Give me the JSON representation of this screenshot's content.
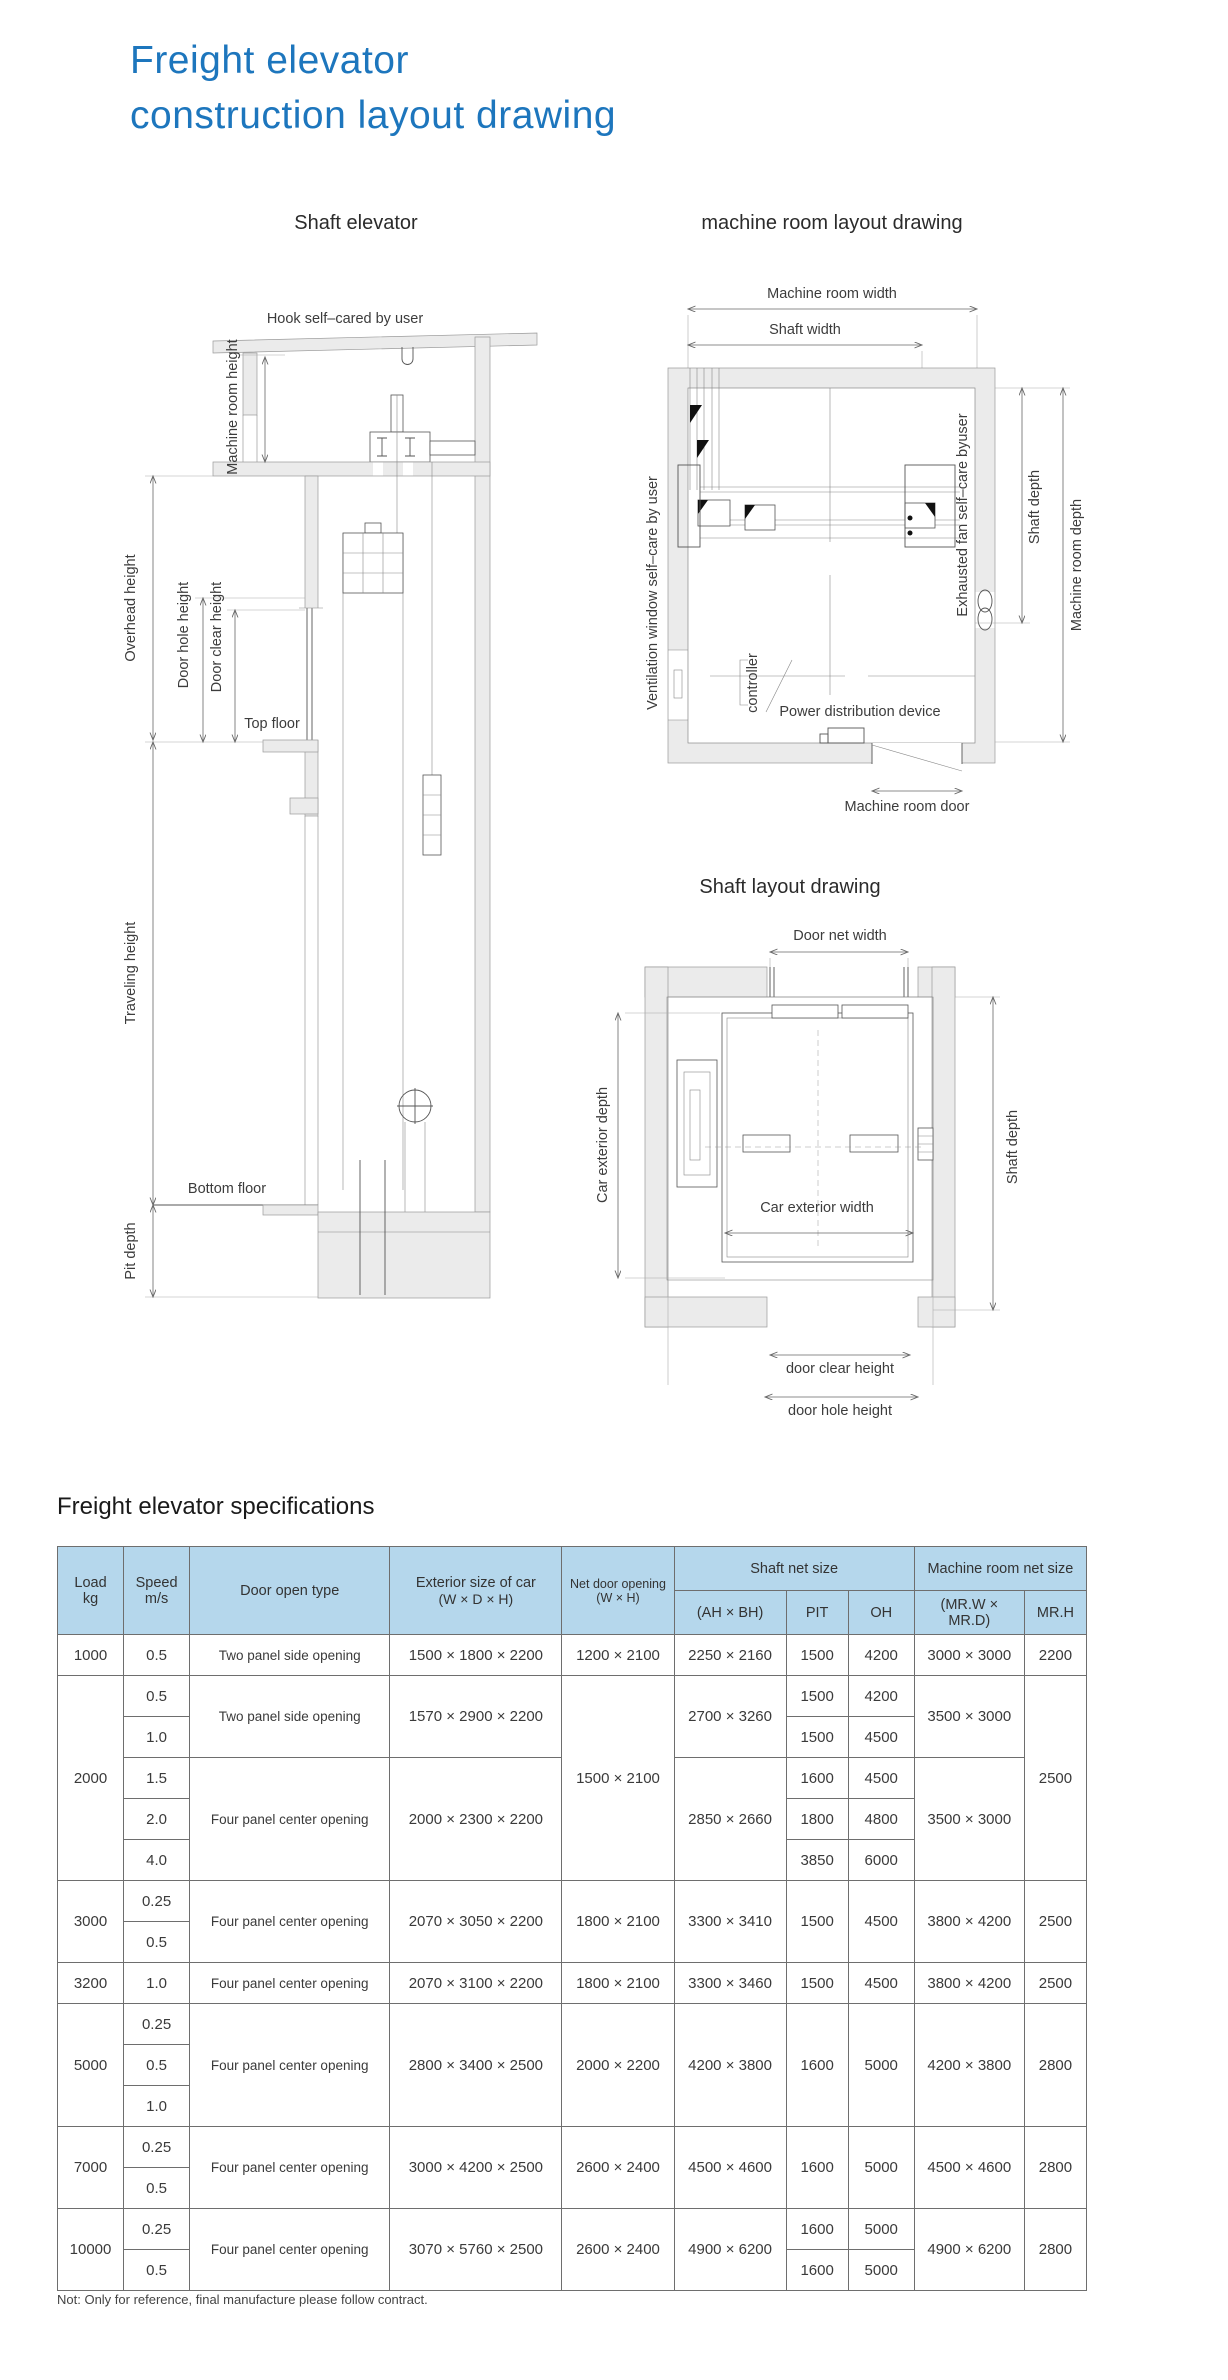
{
  "title": {
    "line1": "Freight elevator",
    "line2": "construction layout drawing"
  },
  "colors": {
    "accent_blue": "#1d76bd",
    "table_header_fill": "#b5d7ec"
  },
  "diagrams": {
    "shaft_elevator": {
      "title": "Shaft elevator",
      "hook": "Hook self–cared by user",
      "overhead": "Overhead height",
      "machine_room_height": "Machine room height",
      "door_hole": "Door hole height",
      "door_clear": "Door clear height",
      "top_floor": "Top floor",
      "traveling": "Traveling height",
      "bottom_floor": "Bottom floor",
      "pit": "Pit depth"
    },
    "machine_room": {
      "title": "machine room layout drawing",
      "width": "Machine room width",
      "shaft_width": "Shaft width",
      "vent": "Ventilation window self–care by user",
      "fan": "Exhausted fan self–care byuser",
      "shaft_depth": "Shaft depth",
      "room_depth": "Machine room depth",
      "controller": "controller",
      "power": "Power distribution device",
      "door": "Machine room door"
    },
    "shaft_plan": {
      "title": "Shaft layout drawing",
      "door_net_width": "Door net width",
      "car_depth": "Car exterior depth",
      "car_width": "Car exterior width",
      "shaft_depth": "Shaft depth",
      "door_clear": "door clear height",
      "door_hole": "door hole height"
    }
  },
  "table": {
    "title": "Freight elevator specifications",
    "header": {
      "load1": "Load",
      "load2": "kg",
      "speed1": "Speed",
      "speed2": "m/s",
      "door": "Door open type",
      "ext1": "Exterior size of car",
      "ext2": "(W × D × H)",
      "net1": "Net door opening",
      "net2": "(W × H)",
      "shaft_group": "Shaft net size",
      "ahbh": "(AH × BH)",
      "pit": "PIT",
      "oh": "OH",
      "mr_group": "Machine room net size",
      "mrwd": "(MR.W × MR.D)",
      "mrh": "MR.H"
    },
    "group_starts": [
      1,
      6,
      8,
      9,
      12,
      14
    ],
    "body": [
      [
        {
          "t": "1000"
        },
        {
          "t": "0.5"
        },
        {
          "t": "Two panel side opening"
        },
        {
          "t": "1500 × 1800 × 2200"
        },
        {
          "t": "1200 × 2100"
        },
        {
          "t": "2250 × 2160"
        },
        {
          "t": "1500"
        },
        {
          "t": "4200"
        },
        {
          "t": "3000 × 3000"
        },
        {
          "t": "2200"
        }
      ],
      [
        {
          "t": "2000",
          "rs": 5
        },
        {
          "t": "0.5"
        },
        {
          "t": "Two panel side opening",
          "rs": 2
        },
        {
          "t": "1570 × 2900 × 2200",
          "rs": 2
        },
        {
          "t": "1500 × 2100",
          "rs": 5
        },
        {
          "t": "2700 × 3260",
          "rs": 2
        },
        {
          "t": "1500"
        },
        {
          "t": "4200"
        },
        {
          "t": "3500 × 3000",
          "rs": 2
        },
        {
          "t": "2500",
          "rs": 5
        }
      ],
      [
        {
          "t": "1.0"
        },
        {
          "t": "1500"
        },
        {
          "t": "4500"
        }
      ],
      [
        {
          "t": "1.5"
        },
        {
          "t": "Four panel center opening",
          "rs": 3
        },
        {
          "t": "2000 × 2300 × 2200",
          "rs": 3
        },
        {
          "t": "2850 × 2660",
          "rs": 3
        },
        {
          "t": "1600"
        },
        {
          "t": "4500"
        },
        {
          "t": "3500 × 3000",
          "rs": 3
        }
      ],
      [
        {
          "t": "2.0"
        },
        {
          "t": "1800"
        },
        {
          "t": "4800"
        }
      ],
      [
        {
          "t": "4.0"
        },
        {
          "t": "3850"
        },
        {
          "t": "6000"
        }
      ],
      [
        {
          "t": "3000",
          "rs": 2
        },
        {
          "t": "0.25"
        },
        {
          "t": "Four panel center opening",
          "rs": 2
        },
        {
          "t": "2070 × 3050 × 2200",
          "rs": 2
        },
        {
          "t": "1800 × 2100",
          "rs": 2
        },
        {
          "t": "3300 × 3410",
          "rs": 2
        },
        {
          "t": "1500",
          "rs": 2
        },
        {
          "t": "4500",
          "rs": 2
        },
        {
          "t": "3800 × 4200",
          "rs": 2
        },
        {
          "t": "2500",
          "rs": 2
        }
      ],
      [
        {
          "t": "0.5"
        }
      ],
      [
        {
          "t": "3200"
        },
        {
          "t": "1.0"
        },
        {
          "t": "Four panel center opening"
        },
        {
          "t": "2070 × 3100 × 2200"
        },
        {
          "t": "1800 × 2100"
        },
        {
          "t": "3300 × 3460"
        },
        {
          "t": "1500"
        },
        {
          "t": "4500"
        },
        {
          "t": "3800 × 4200"
        },
        {
          "t": "2500"
        }
      ],
      [
        {
          "t": "5000",
          "rs": 3
        },
        {
          "t": "0.25"
        },
        {
          "t": "Four panel center opening",
          "rs": 3
        },
        {
          "t": "2800 × 3400 × 2500",
          "rs": 3
        },
        {
          "t": "2000 × 2200",
          "rs": 3
        },
        {
          "t": "4200 × 3800",
          "rs": 3
        },
        {
          "t": "1600",
          "rs": 3
        },
        {
          "t": "5000",
          "rs": 3
        },
        {
          "t": "4200 × 3800",
          "rs": 3
        },
        {
          "t": "2800",
          "rs": 3
        }
      ],
      [
        {
          "t": "0.5"
        }
      ],
      [
        {
          "t": "1.0"
        }
      ],
      [
        {
          "t": "7000",
          "rs": 2
        },
        {
          "t": "0.25"
        },
        {
          "t": "Four panel center opening",
          "rs": 2
        },
        {
          "t": "3000 × 4200 × 2500",
          "rs": 2
        },
        {
          "t": "2600 × 2400",
          "rs": 2
        },
        {
          "t": "4500 × 4600",
          "rs": 2
        },
        {
          "t": "1600",
          "rs": 2
        },
        {
          "t": "5000",
          "rs": 2
        },
        {
          "t": "4500 × 4600",
          "rs": 2
        },
        {
          "t": "2800",
          "rs": 2
        }
      ],
      [
        {
          "t": "0.5"
        }
      ],
      [
        {
          "t": "10000",
          "rs": 2
        },
        {
          "t": "0.25"
        },
        {
          "t": "Four panel center opening",
          "rs": 2
        },
        {
          "t": "3070 × 5760 × 2500",
          "rs": 2
        },
        {
          "t": "2600 × 2400",
          "rs": 2
        },
        {
          "t": "4900 × 6200",
          "rs": 2
        },
        {
          "t": "1600"
        },
        {
          "t": "5000"
        },
        {
          "t": "4900 × 6200",
          "rs": 2
        },
        {
          "t": "2800",
          "rs": 2
        }
      ],
      [
        {
          "t": "0.5"
        },
        {
          "t": "1600"
        },
        {
          "t": "5000"
        }
      ]
    ]
  },
  "note": "Not: Only for reference, final manufacture please follow contract."
}
